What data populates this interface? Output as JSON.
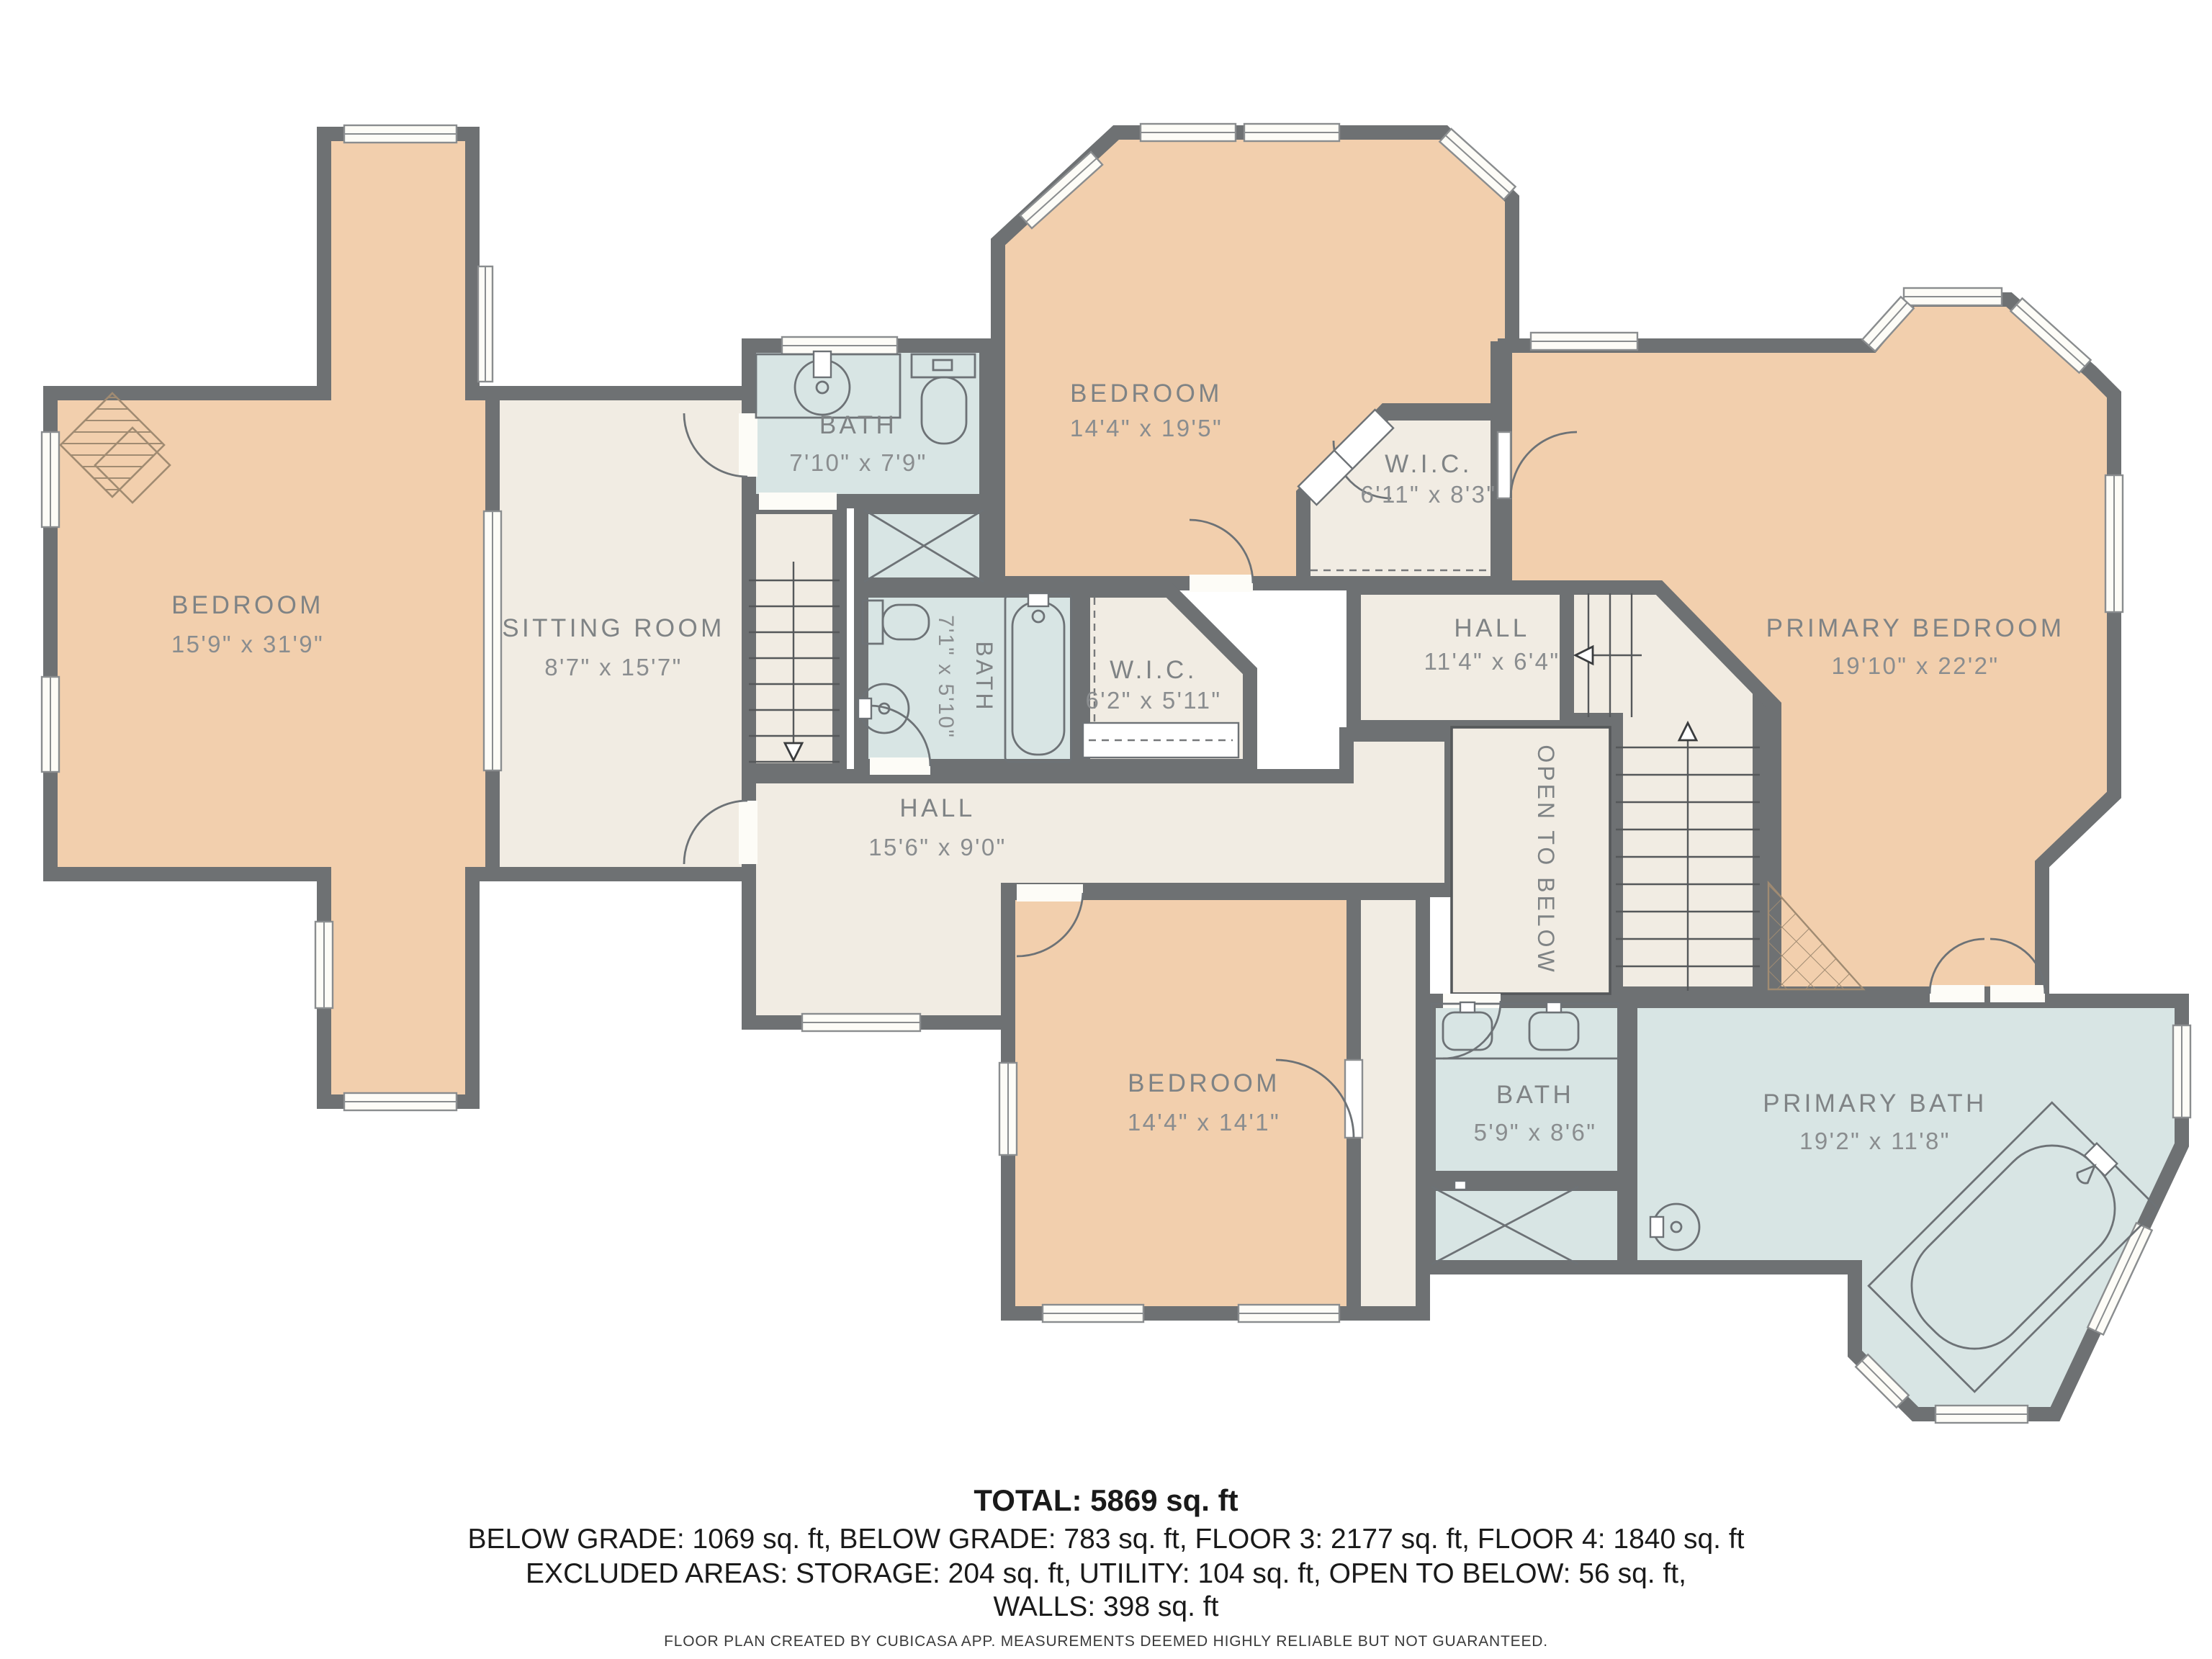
{
  "colors": {
    "walls": "#6e7173",
    "bedroom_fill": "#f2cfad",
    "bath_fill": "#d8e5e4",
    "hall_fill": "#f1ece3",
    "label_text": "#7f8385",
    "decor_line": "#a08b72",
    "footer_text": "#1a1a1a"
  },
  "rooms": {
    "bedroom_left": {
      "name": "BEDROOM",
      "dims": "15'9\" x 31'9\""
    },
    "sitting_room": {
      "name": "SITTING ROOM",
      "dims": "8'7\" x 15'7\""
    },
    "bath_top": {
      "name": "BATH",
      "dims": "7'10\" x 7'9\""
    },
    "bedroom_top": {
      "name": "BEDROOM",
      "dims": "14'4\" x 19'5\""
    },
    "wic_top": {
      "name": "W.I.C.",
      "dims": "6'11\" x 8'3\""
    },
    "hall_top": {
      "name": "HALL",
      "dims": "11'4\" x 6'4\""
    },
    "primary_bedroom": {
      "name": "PRIMARY BEDROOM",
      "dims": "19'10\" x 22'2\""
    },
    "bath_mid": {
      "name": "BATH",
      "dims": "7'1\" x 5'10\""
    },
    "wic_mid": {
      "name": "W.I.C.",
      "dims": "6'2\" x 5'11\""
    },
    "hall_center": {
      "name": "HALL",
      "dims": "15'6\" x 9'0\""
    },
    "open_to_below": {
      "name": "OPEN TO BELOW"
    },
    "bedroom_bottom": {
      "name": "BEDROOM",
      "dims": "14'4\" x 14'1\""
    },
    "bath_bottom": {
      "name": "BATH",
      "dims": "5'9\" x 8'6\""
    },
    "primary_bath": {
      "name": "PRIMARY BATH",
      "dims": "19'2\" x 11'8\""
    }
  },
  "footer": {
    "total": "TOTAL: 5869 sq. ft",
    "line2": "BELOW GRADE: 1069 sq. ft, BELOW GRADE: 783 sq. ft, FLOOR 3: 2177 sq. ft, FLOOR 4: 1840 sq. ft",
    "line3": "EXCLUDED AREAS: STORAGE: 204 sq. ft, UTILITY: 104 sq. ft, OPEN TO BELOW: 56 sq. ft,",
    "line4": "WALLS: 398 sq. ft",
    "disclaimer": "FLOOR PLAN CREATED BY CUBICASA APP. MEASUREMENTS DEEMED HIGHLY RELIABLE BUT NOT GUARANTEED."
  }
}
